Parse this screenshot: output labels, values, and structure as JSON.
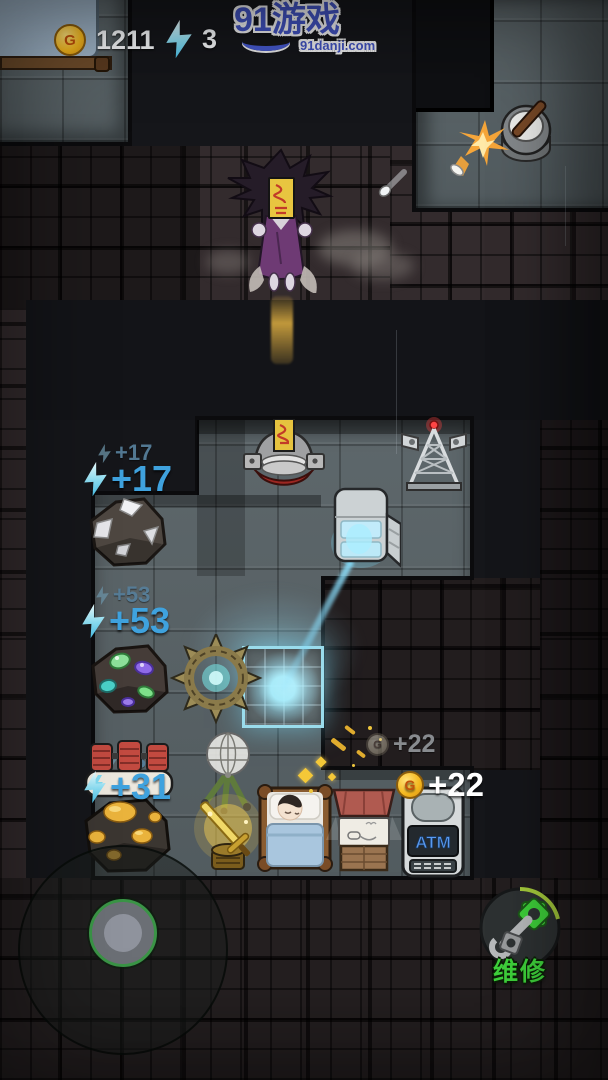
{
  "hud": {
    "gold": {
      "symbol": "G",
      "value": "1211"
    },
    "energy": {
      "value": "3"
    }
  },
  "watermark": {
    "title": "91游戏",
    "subtitle": "91danji.com"
  },
  "floats": {
    "energy17_old": "+17",
    "energy17": "+17",
    "energy53_old": "+53",
    "energy53": "+53",
    "energy31_old": "+31",
    "energy31": "+31",
    "gold22_old": "+22",
    "gold22": "+22",
    "coin_symbol": "G"
  },
  "machines": {
    "atm_label": "ATM"
  },
  "controls": {
    "repair_label": "维修"
  },
  "colors": {
    "energy_text": "#3fa2de",
    "energy_text_faded": "#567e99",
    "coin_gold": "#f2b81f",
    "gold_text": "#ffffff",
    "repair_green": "#3fd43c",
    "beam_cyan": "#7fd8f2",
    "room_tile": "#576165",
    "brick": "#332b2d"
  }
}
